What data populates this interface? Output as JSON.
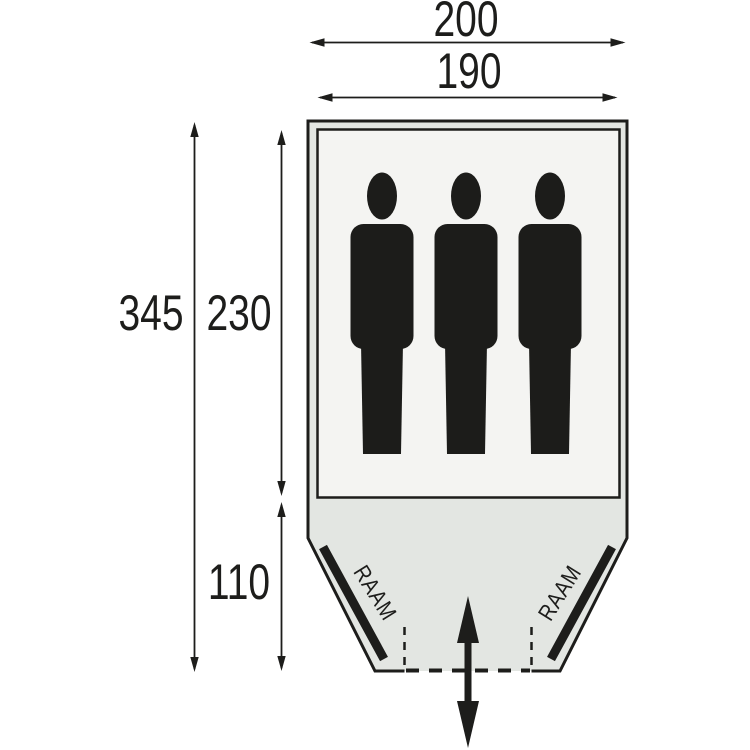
{
  "floorplan": {
    "dimension_labels": {
      "outer_width": "200",
      "inner_width": "190",
      "total_depth": "345",
      "inner_depth": "230",
      "porch_depth": "110"
    },
    "window_labels": {
      "left": "RAAM",
      "right": "RAAM"
    },
    "occupants": {
      "count": 3
    },
    "colors": {
      "outline": "#1d1d1b",
      "porch_fill": "#e3e6e2",
      "cabin_fill": "#f4f4f2",
      "silhouette": "#1c1c1a",
      "background": "#ffffff"
    }
  }
}
